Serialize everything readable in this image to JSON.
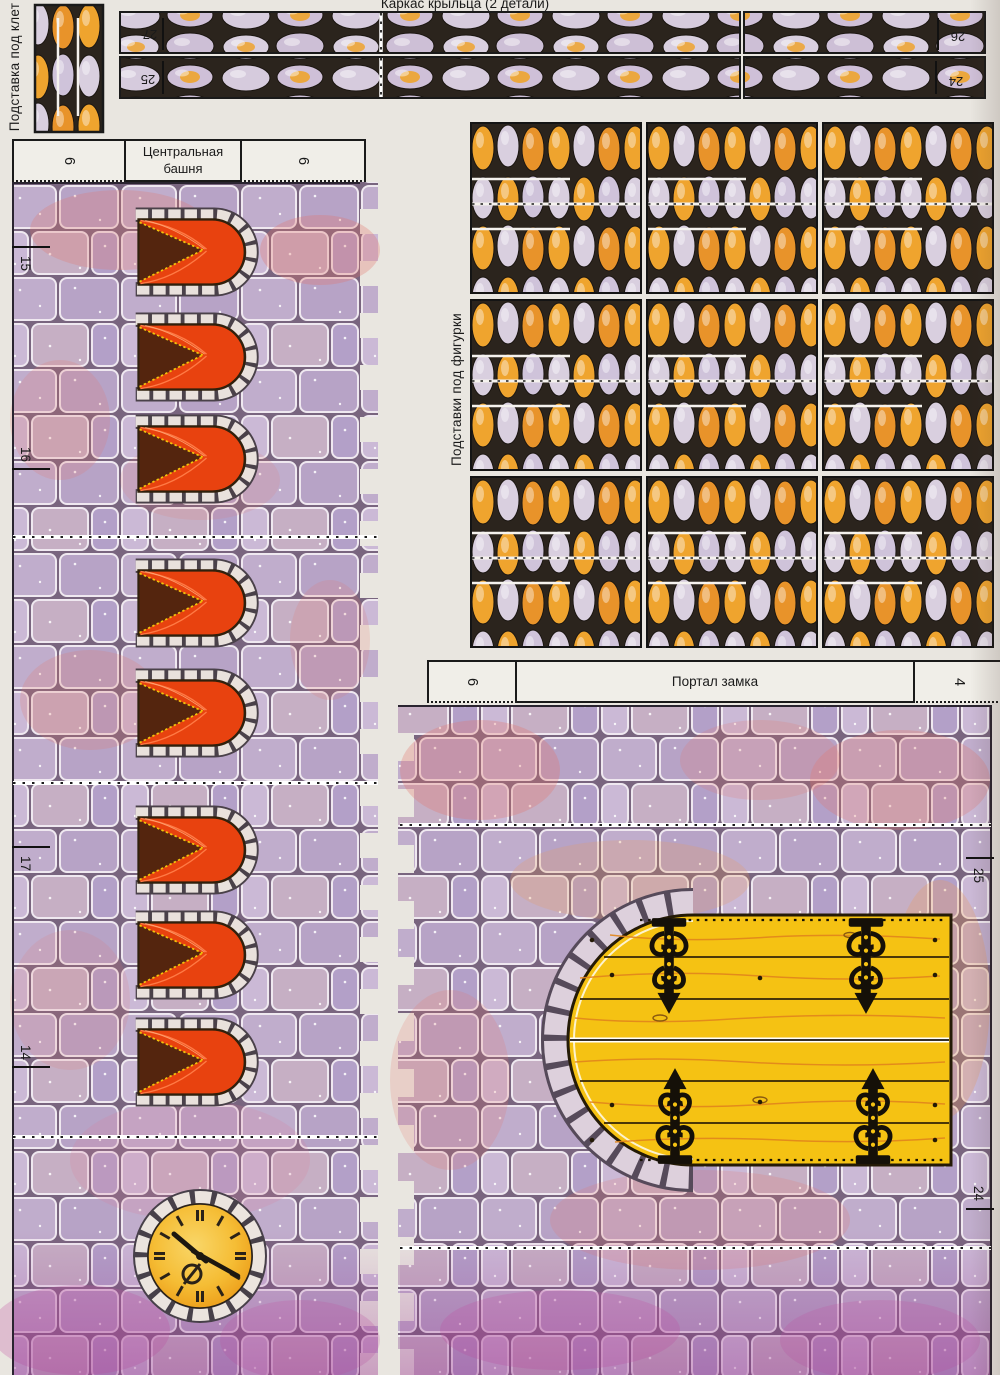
{
  "labels": {
    "cage_stand": "Подставка под клет",
    "porch_frame_title": "Каркас крыльца (2 детали)",
    "tower_title_line1": "Центральная",
    "tower_title_line2": "башня",
    "figurine_stands": "Подставки под фигурки",
    "portal_title": "Портал замка"
  },
  "porch_strip": {
    "top_left": "27",
    "bottom_left": "25",
    "top_right": "26",
    "bottom_right": "24"
  },
  "tower": {
    "tab_left": "6",
    "tab_right": "6",
    "edge_numbers": [
      "15",
      "16",
      "17",
      "14"
    ]
  },
  "portal": {
    "tab_left": "6",
    "tab_right": "4",
    "edge_top": "25",
    "edge_bottom": "24"
  },
  "colors": {
    "paper": "#e9e6e0",
    "brick_lavender": "#bfaccb",
    "brick_grout": "#79657f",
    "brick_pink_tint": "#e4756a",
    "cobble_orange": "#efa42e",
    "cobble_lavender": "#d9cfdf",
    "cobble_background": "#2b241d",
    "window_red": "#e8420f",
    "window_shadow_brown": "#54250e",
    "door_yellow": "#f5c213",
    "ironwork_black": "#151008",
    "stone_trim": "#e9e1dc",
    "line_black": "#1a1a1a"
  }
}
